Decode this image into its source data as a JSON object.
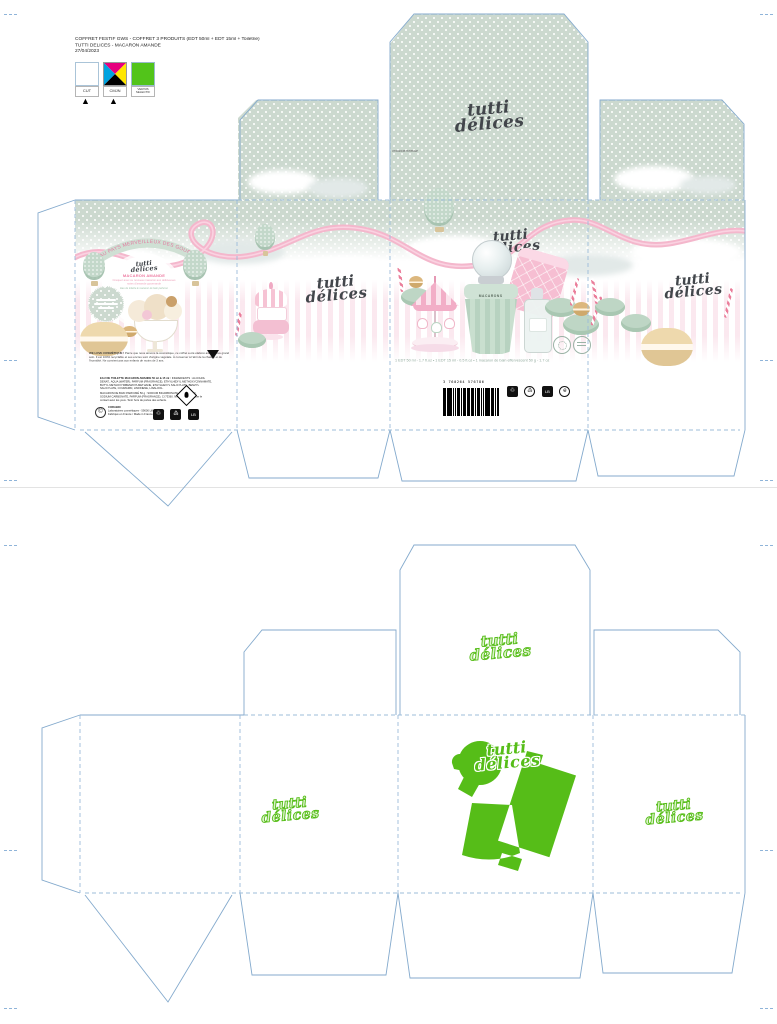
{
  "header": {
    "line1": "COFFRET FESTIF GWS - COFFRET 3 PRODUITS (EDT 50ml + EDT 15ml + Toiletrie)",
    "line2": "TUTTI DELICES - MACARON AMANDE",
    "line3": "27/04/2023"
  },
  "legend": {
    "cut_label": "CUT",
    "cmyk_label": "CMJN",
    "varnish_line1": "VERNIS",
    "varnish_line2": "SELECTIF",
    "varnish_color": "#52c41a",
    "cut_color": "#ffffff"
  },
  "brand": {
    "line1": "tutti",
    "line2": "délices"
  },
  "printed": {
    "flap_code": "3760264576786GP",
    "back": {
      "arc_text": "AU PAYS MERVEILLEUX DES GOURMANDISES",
      "title": "MACARON AMANDE",
      "blurb": "Craquez avec ce nouveau macaron aux délicieuses notes d'amande gourmande",
      "note": "Eau de toilette & macaron de bain parfumé",
      "legal_bold": "WE LOVE COSMÉTIQUE !",
      "legal_text": "Parce que nous aimons la cosmétique, ce coffret a été élaboré avec le plus grand soin. Il est 100% recyclable et ses encres sont d'origine végétale. À conserver à l'abri de la chaleur et de l'humidité. Ne convient pas aux enfants de moins de 3 ans.",
      "ing_title": "EAU DE TOILETTE MACARON AMANDE 50 ml & 15 ml :",
      "ing_text": "INGREDIENTS : ALCOHOL DENAT., AQUA (WATER), PARFUM (FRAGRANCE), ETHYLHEXYL METHOXYCINNAMATE, BUTYL METHOXYDIBENZOYLMETHANE, ETHYLHEXYL SALICYLATE, BENZYL SALICYLATE, COUMARIN, LIMONENE, LINALOOL.",
      "warn_text": "MACARON DE BAIN PARFUMÉ 50 g : SODIUM BICARBONATE, CITRIC ACID, SODIUM CARBONATE, PARFUM (FRAGRANCE), CI 73360. Ne pas avaler. Éviter le contact avec les yeux. Tenir hors de portée des enfants.",
      "company_name": "CORABIO",
      "company_text": "Laboratoires cosmétiques - 59000 Lille, France. Fabriqué en France / Made in France.",
      "copyright": "©",
      "lb_mark": "LB"
    },
    "front": {
      "contents": "1 EDT 50 ml - 1.7 fl.oz  •  1 EDT 15 ml - 0.5 fl.oz  •  1 macaron de bain effervescent 50 g - 1.7 oz",
      "bottle_label": "MACARONS",
      "barcode_number": "3 760264 576786"
    }
  },
  "colors": {
    "mint": "#ccd9cf",
    "pink_ribbon": "#f4b7cc",
    "logo_dark": "#42464b",
    "green_varnish": "#56bd18",
    "dieline_blue": "#84aacd"
  }
}
